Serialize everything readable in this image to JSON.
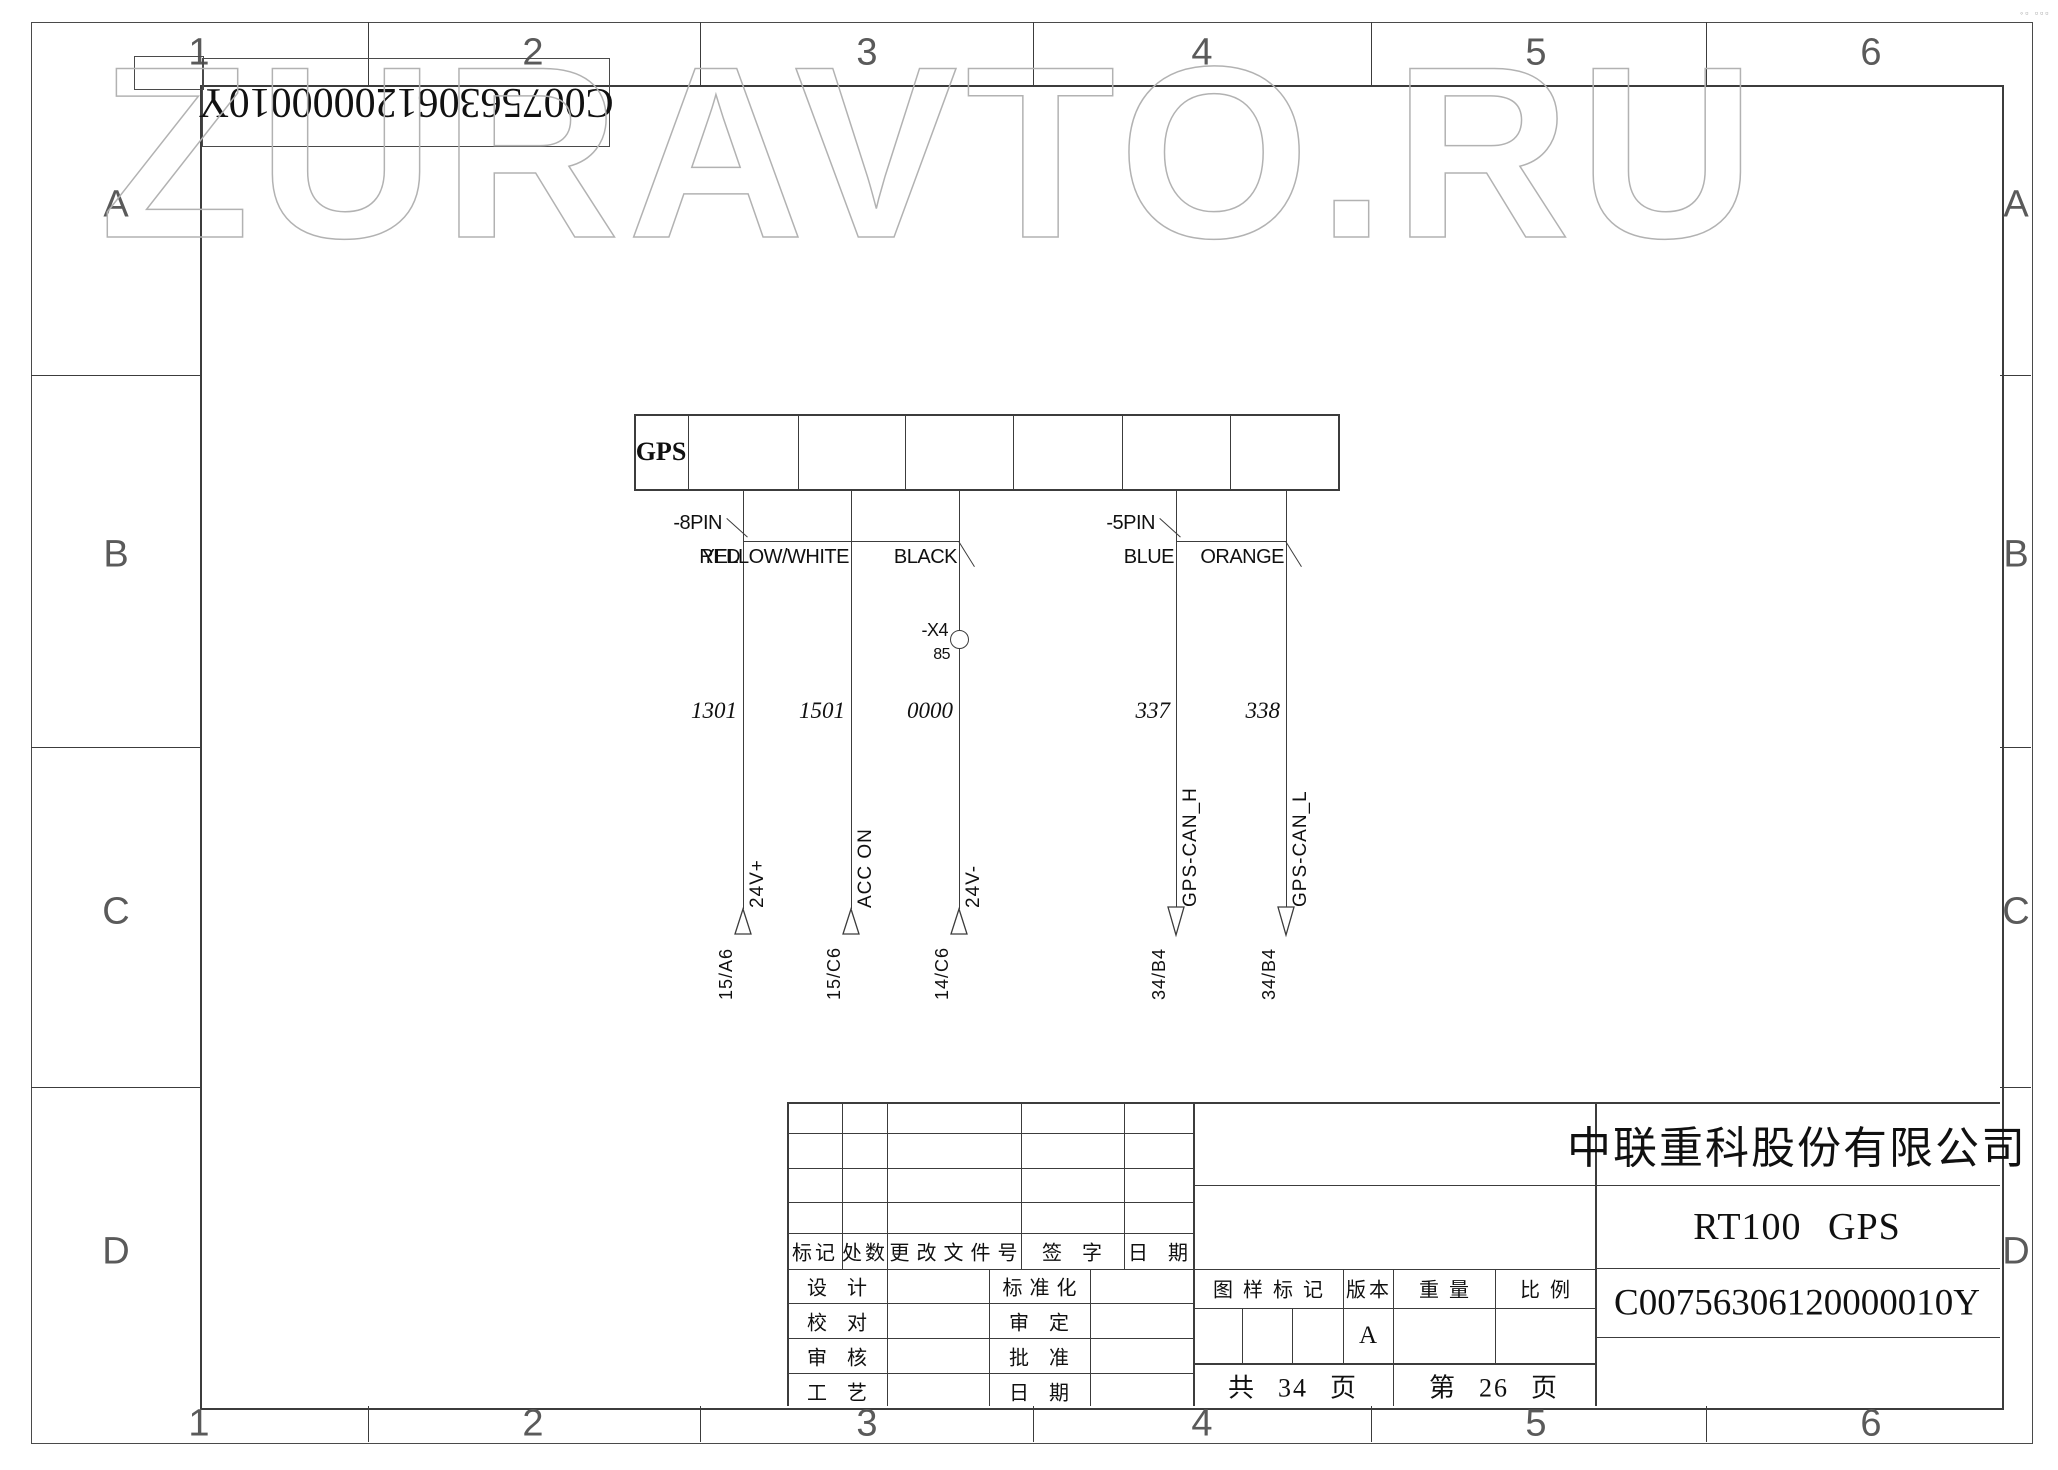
{
  "frame": {
    "zone_cols": [
      "1",
      "2",
      "3",
      "4",
      "5",
      "6"
    ],
    "zone_rows": [
      "A",
      "B",
      "C",
      "D"
    ],
    "stamp": "◦▫ ▫▫▫"
  },
  "watermark": {
    "text": "ZURAVTO.RU"
  },
  "corner_label": {
    "text": "C00756306120000010Y"
  },
  "diagram": {
    "device_label": "GPS",
    "x4": {
      "label": "-X4",
      "pin": "85"
    },
    "connector_8pin": {
      "label": "-8PIN",
      "wires": [
        {
          "color": "RED",
          "number": "1301",
          "signal": "24V+",
          "ref": "15/A6"
        },
        {
          "color": "YELLOW/WHITE",
          "number": "1501",
          "signal": "ACC ON",
          "ref": "15/C6"
        },
        {
          "color": "BLACK",
          "number": "0000",
          "signal": "24V-",
          "ref": "14/C6"
        }
      ]
    },
    "connector_5pin": {
      "label": "-5PIN",
      "wires": [
        {
          "color": "BLUE",
          "number": "337",
          "signal": "GPS-CAN_H",
          "ref": "34/B4"
        },
        {
          "color": "ORANGE",
          "number": "338",
          "signal": "GPS-CAN_L",
          "ref": "34/B4"
        }
      ]
    }
  },
  "title_block": {
    "revision_headers": [
      "标记",
      "处数",
      "更改文件号",
      "签字",
      "日期"
    ],
    "sign_rows_left": [
      "设计",
      "校对",
      "审核",
      "工艺"
    ],
    "sign_rows_right": [
      "标准化",
      "审定",
      "批准",
      "日期"
    ],
    "spec_headers": [
      "图样标记",
      "版本",
      "重量",
      "比例"
    ],
    "version": "A",
    "pages_total": {
      "prefix": "共",
      "num": "34",
      "suffix": "页"
    },
    "page_current": {
      "prefix": "第",
      "num": "26",
      "suffix": "页"
    },
    "company": "中联重科股份有限公司",
    "product": "RT100 GPS",
    "drawing_number": "C00756306120000010Y"
  }
}
